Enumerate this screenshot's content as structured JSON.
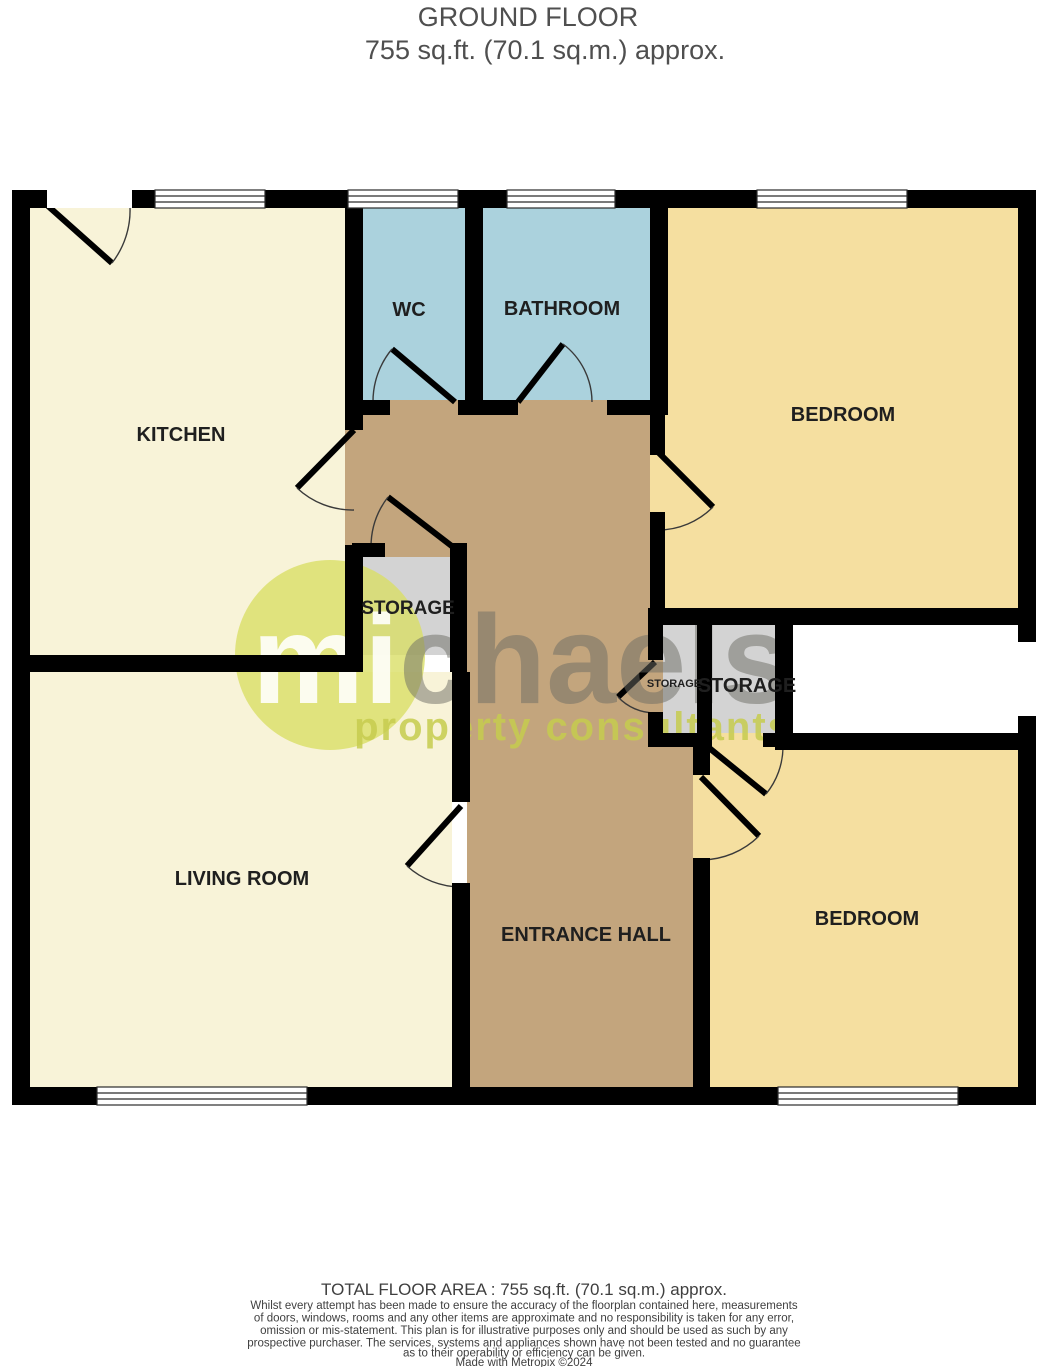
{
  "header": {
    "title": "GROUND FLOOR",
    "subtitle": "755 sq.ft. (70.1 sq.m.) approx."
  },
  "rooms": {
    "kitchen": "KITCHEN",
    "wc": "WC",
    "bathroom": "BATHROOM",
    "bedroom_top": "BEDROOM",
    "storage": "STORAGE",
    "storage_small_left": "STORAGE",
    "storage_small_right": "STORAGE",
    "living": "LIVING ROOM",
    "hall": "ENTRANCE HALL",
    "bedroom_bottom": "BEDROOM"
  },
  "watermark": {
    "logo_start": "mi",
    "logo_end": "chaels",
    "tagline": "property consultants"
  },
  "colors": {
    "room_cream": "#f8f3d8",
    "room_blue": "#abd2dd",
    "room_yellow": "#f5dfa0",
    "room_gray": "#d3d3d3",
    "hall_brown": "#c3a57d",
    "wall_black": "#000000",
    "logo_circle_green": "#d9de67",
    "logo_text_gray": "#6b6b64",
    "tagline_green": "#c6cb4d"
  },
  "footer": {
    "total_area": "TOTAL FLOOR AREA : 755 sq.ft. (70.1 sq.m.) approx.",
    "disclaimer_lines": [
      "Whilst every attempt has been made to ensure the accuracy of the floorplan contained here, measurements",
      "of doors, windows, rooms and any other items are approximate and no responsibility is taken for any error,",
      "omission or mis-statement. This plan is for illustrative purposes only and should be used as such by any",
      "prospective purchaser. The services, systems and appliances shown have not been tested and no guarantee",
      "as to their operability or efficiency can be given."
    ],
    "credit": "Made with Metropix ©2024"
  }
}
